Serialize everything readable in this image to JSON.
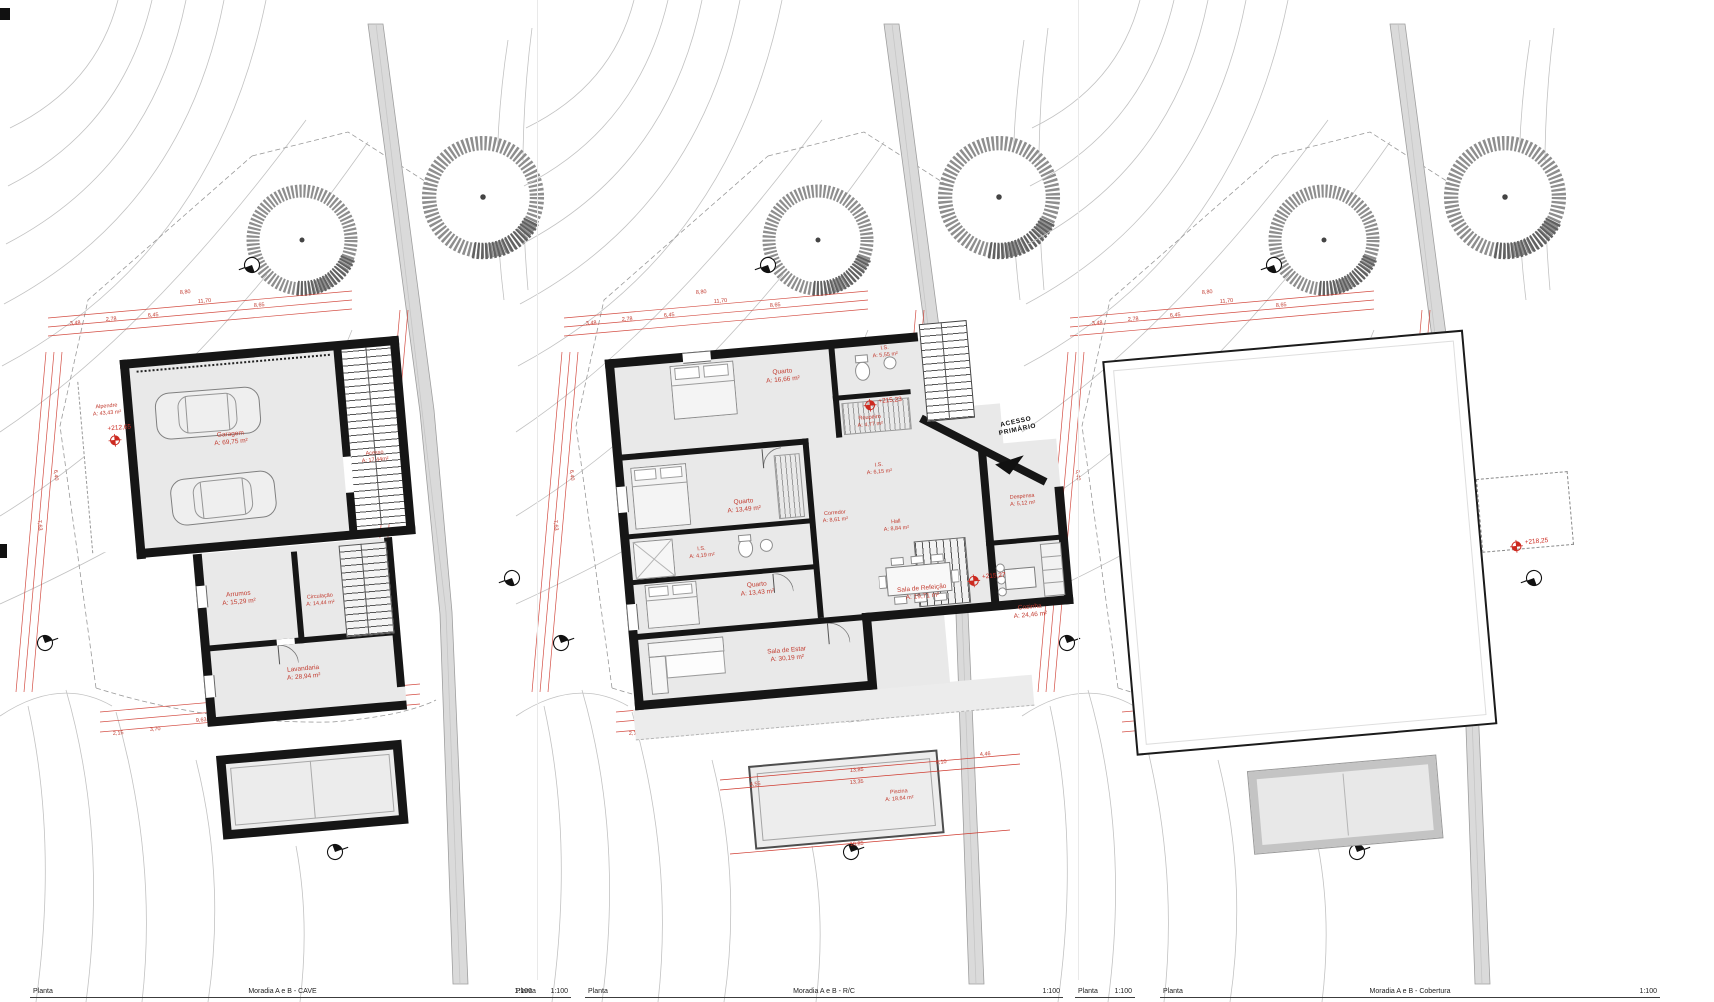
{
  "site_dims": [
    "3,48",
    "2,78",
    "6,45",
    "11,70",
    "8,65",
    "8,80",
    "7,63",
    "6,40",
    "12,75",
    "9,63",
    "3,70",
    "2,15",
    "2,45"
  ],
  "title_blocks": [
    {
      "label": "Planta",
      "title": "Moradia A e B - CAVE",
      "scale": "1:100"
    },
    {
      "label": "Planta",
      "scale": "1:100"
    },
    {
      "label": "Planta",
      "title": "Moradia A e B - R/C",
      "scale": "1:100"
    },
    {
      "label": "Planta",
      "scale": "1:100"
    },
    {
      "label": "Planta",
      "title": "Moradia A e B - Cobertura",
      "scale": "1:100"
    }
  ],
  "cave": {
    "level": "+212,65",
    "rooms": {
      "alpendre": {
        "name": "Alpendre",
        "area": "A: 43,43 m²"
      },
      "garagem": {
        "name": "Garagem",
        "area": "A: 69,75 m²"
      },
      "acesso": {
        "name": "Acesso",
        "area": "A: 17,44m²"
      },
      "arrumos": {
        "name": "Arrumos",
        "area": "A: 15,29 m²"
      },
      "circulacao": {
        "name": "Circulação",
        "area": "A: 14,44 m²"
      },
      "lavandaria": {
        "name": "Lavandaria",
        "area": "A: 28,94 m²"
      }
    }
  },
  "rc": {
    "levels": [
      "+215,23",
      "+215,27"
    ],
    "acesso_line1": "ACESSO",
    "acesso_line2": "PRIMÁRIO",
    "dims": [
      "13,85",
      "13,35",
      "10,85",
      "8,10",
      "4,55",
      "4,46"
    ],
    "rooms": {
      "quarto1": {
        "name": "Quarto",
        "area": "A: 16,66 m²"
      },
      "is1": {
        "name": "I.S.",
        "area": "A: 5,55 m²"
      },
      "roupeiro": {
        "name": "Roupeiro",
        "area": "A: 4,77 m²"
      },
      "quarto2": {
        "name": "Quarto",
        "area": "A: 13,49 m²"
      },
      "is2": {
        "name": "I.S.",
        "area": "A: 4,19 m²"
      },
      "is3": {
        "name": "I.S.",
        "area": "A: 6,15 m²"
      },
      "quarto3": {
        "name": "Quarto",
        "area": "A: 13,43 m²"
      },
      "corredor": {
        "name": "Corredor",
        "area": "A: 8,61 m²"
      },
      "hall": {
        "name": "Hall",
        "area": "A: 8,84 m²"
      },
      "despensa": {
        "name": "Despensa",
        "area": "A: 5,12 m²"
      },
      "cozinha": {
        "name": "Cozinha",
        "area": "A: 24,46 m²"
      },
      "sala_estar": {
        "name": "Sala de Estar",
        "area": "A: 30,19 m²"
      },
      "sala_refeicao": {
        "name": "Sala de Refeição",
        "area": "A: 19,71 m²"
      },
      "piscina": {
        "name": "Piscina",
        "area": "A: 18,64 m²"
      }
    }
  },
  "cobertura": {
    "level": "+218,25"
  }
}
